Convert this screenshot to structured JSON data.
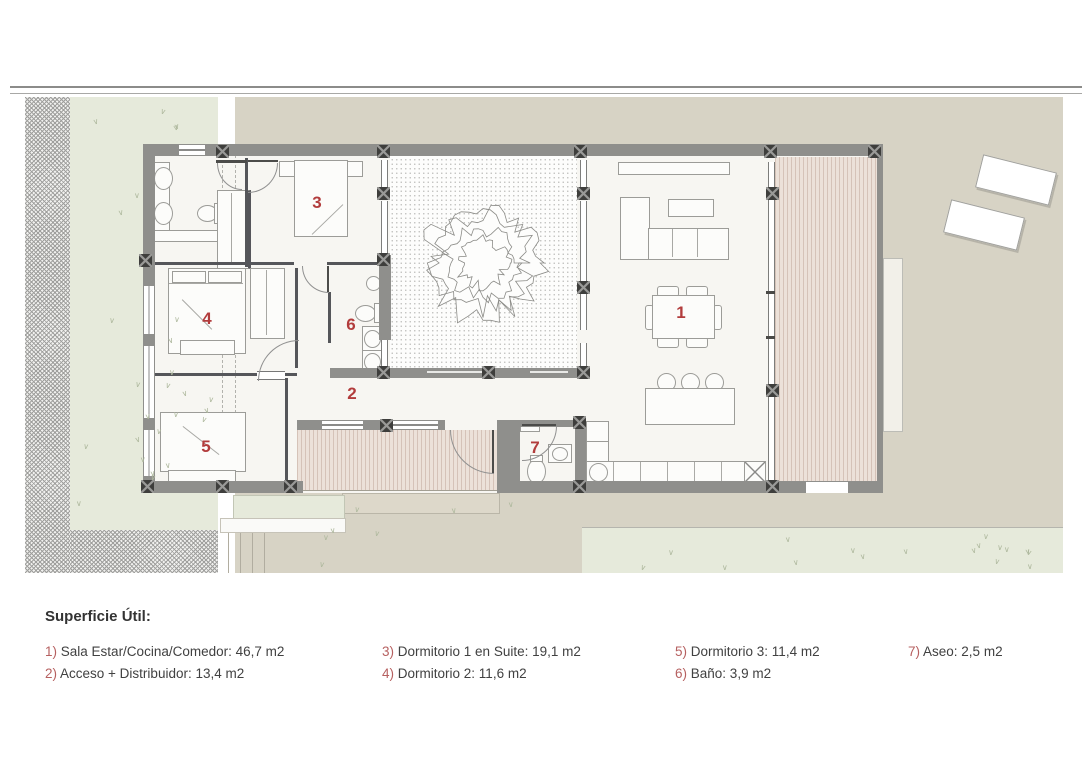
{
  "plan": {
    "rooms": [
      {
        "num": "1"
      },
      {
        "num": "2"
      },
      {
        "num": "3"
      },
      {
        "num": "4"
      },
      {
        "num": "5"
      },
      {
        "num": "6"
      },
      {
        "num": "7"
      }
    ]
  },
  "legend": {
    "title": "Superficie Útil:",
    "columns": [
      {
        "items": [
          {
            "num": "1)",
            "text": "Sala Estar/Cocina/Comedor: 46,7 m2"
          },
          {
            "num": "2)",
            "text": "Acceso + Distribuidor: 13,4 m2"
          }
        ]
      },
      {
        "items": [
          {
            "num": "3)",
            "text": "Dormitorio 1 en Suite: 19,1 m2"
          },
          {
            "num": "4)",
            "text": "Dormitorio 2: 11,6 m2"
          }
        ]
      },
      {
        "items": [
          {
            "num": "5)",
            "text": "Dormitorio 3: 11,4 m2"
          },
          {
            "num": "6)",
            "text": "Baño: 3,9 m2"
          }
        ]
      },
      {
        "items": [
          {
            "num": "7)",
            "text": "Aseo: 2,5 m2"
          }
        ]
      }
    ]
  },
  "decor": {
    "grass_glyph": "∨"
  },
  "colors": {
    "accent_red": "#b23c3c",
    "legend_num_red": "#b66060",
    "ground_beige": "#d7d3c5",
    "garden_green": "#e6eadb",
    "wall_gray": "#8f8f8c",
    "column_dark": "#3e3e3c",
    "deck_tan": "#ece1d9",
    "text_dark": "#414141"
  }
}
